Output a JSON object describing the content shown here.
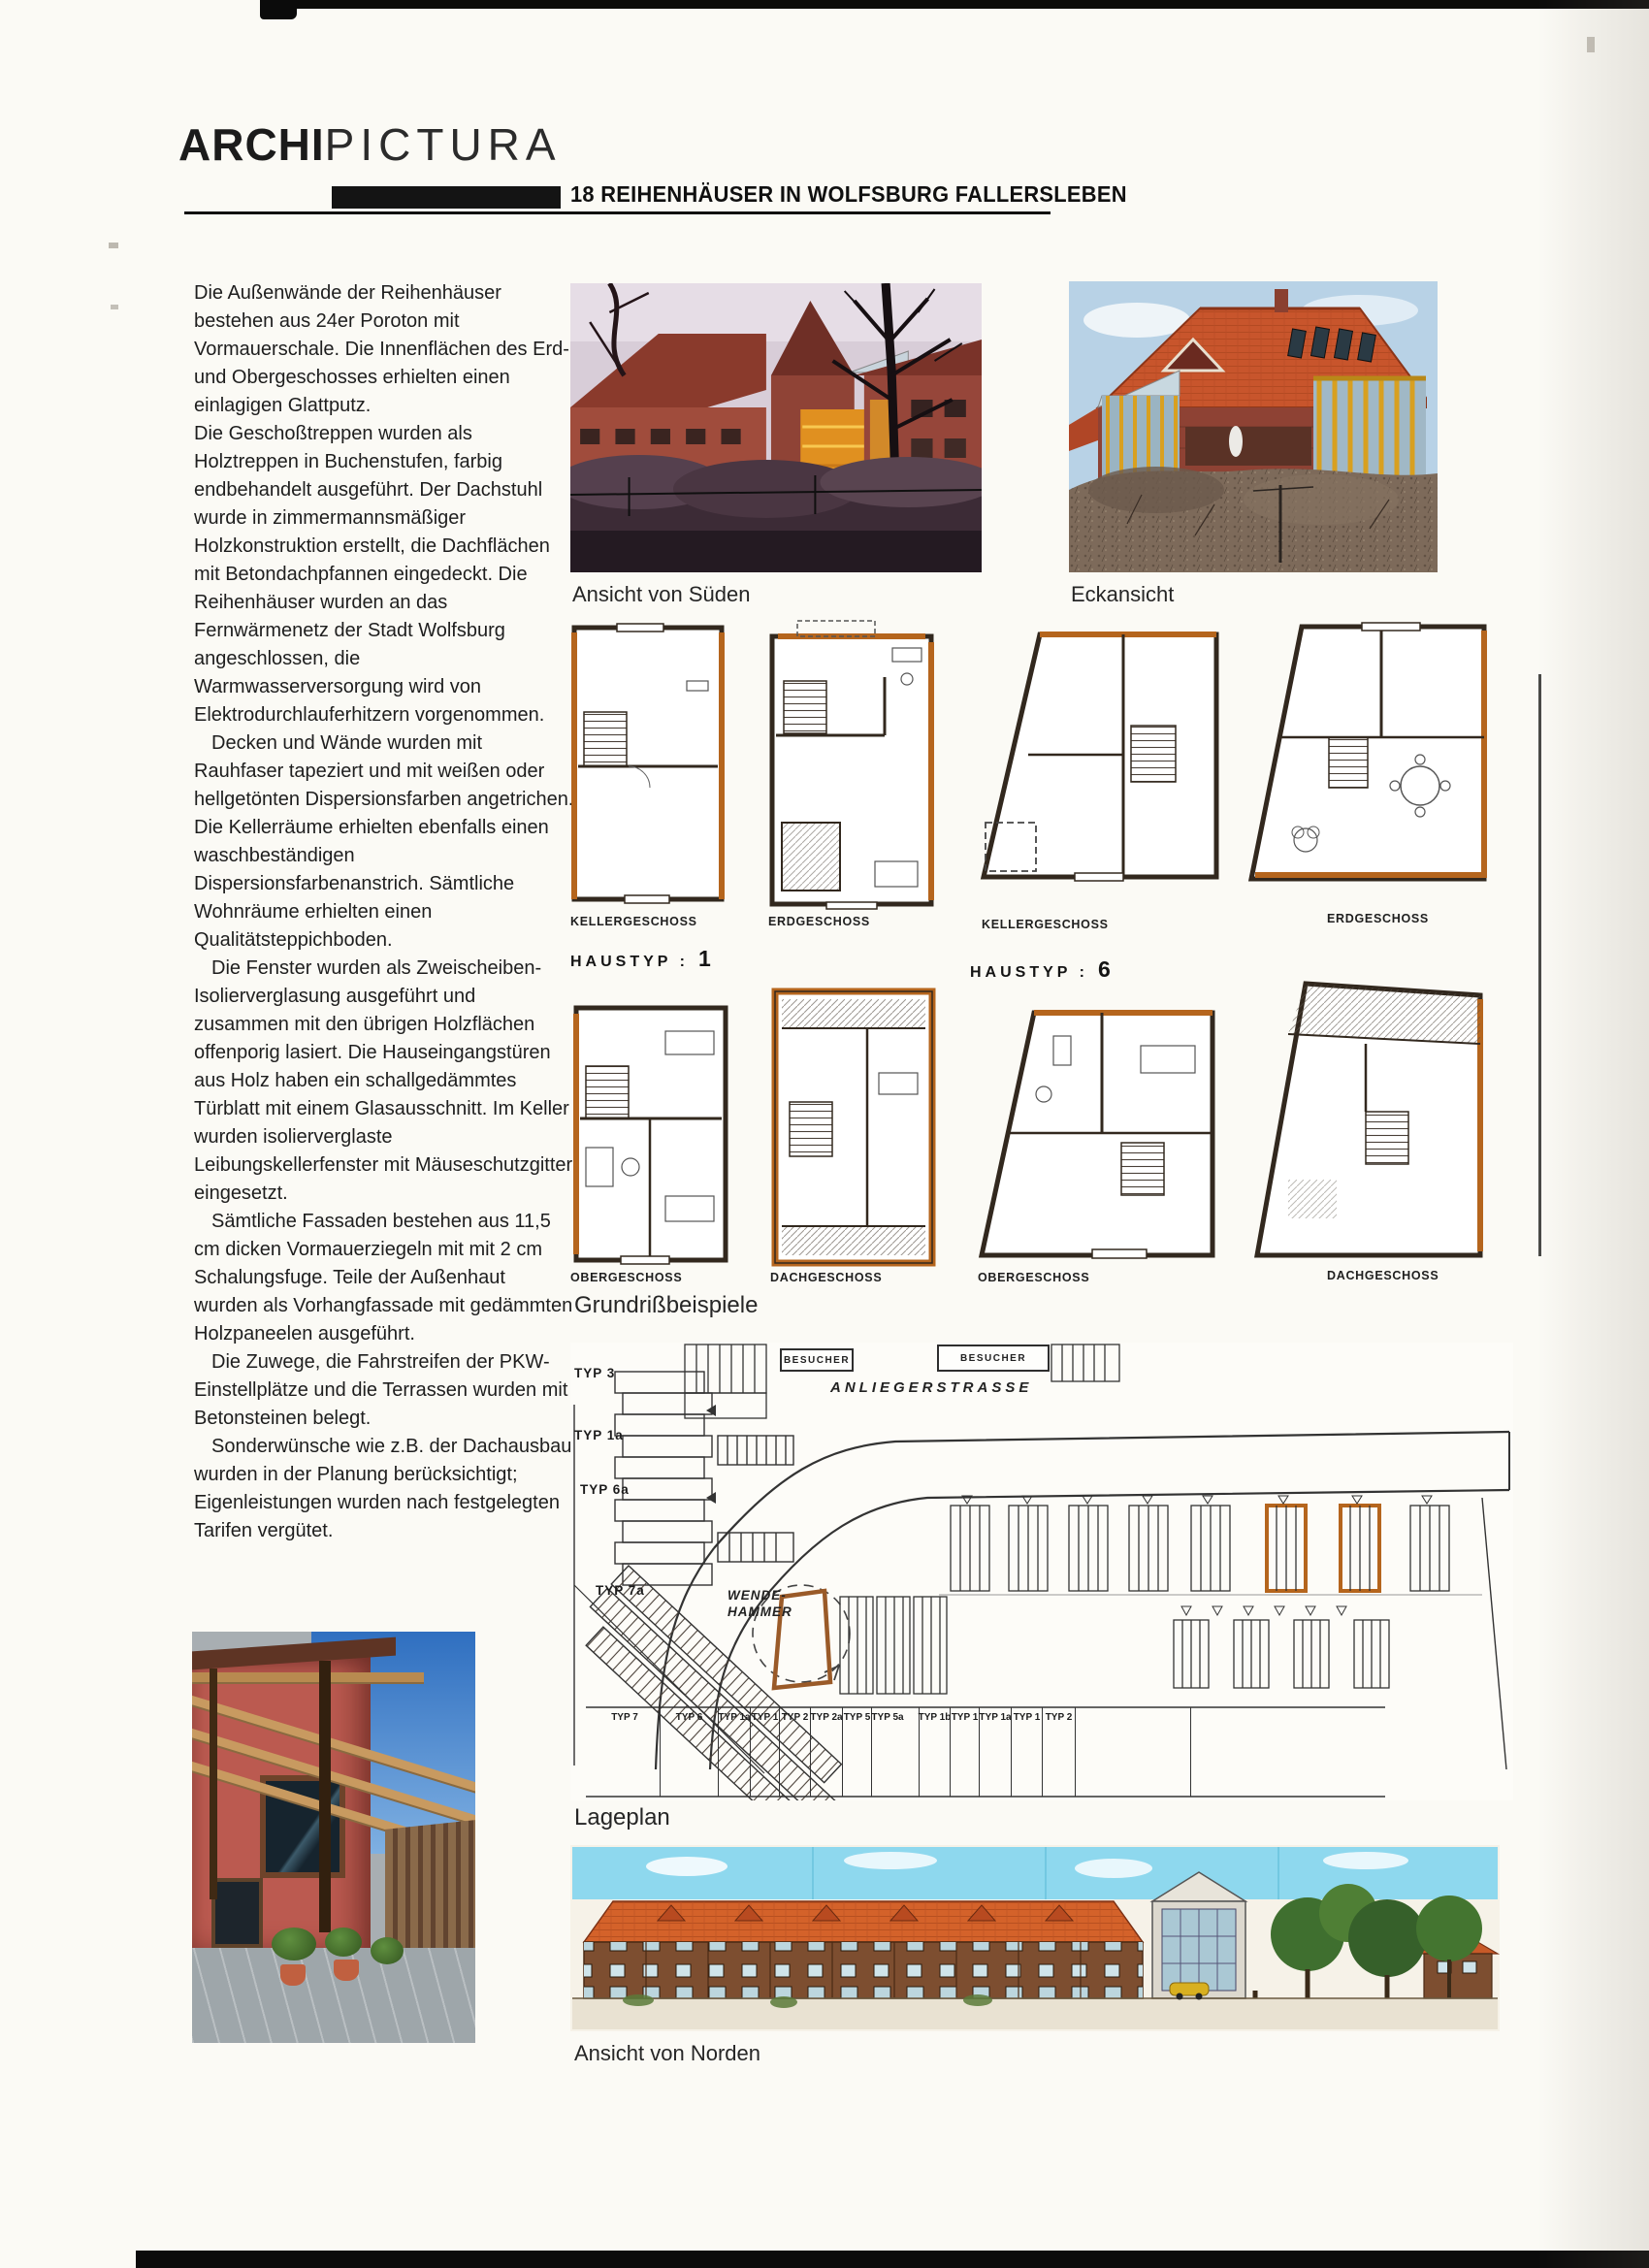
{
  "header": {
    "brand_bold": "ARCHI",
    "brand_light": "PICTURA",
    "title": "18 REIHENHÄUSER IN WOLFSBURG FALLERSLEBEN"
  },
  "article": {
    "p1": "Die Außenwände der Reihenhäuser bestehen aus 24er Poroton mit Vormauerschale. Die Innenflächen des Erd- und Obergeschosses erhielten einen einlagigen Glattputz.",
    "p2": "Die Geschoßtreppen wurden als Holztreppen in Buchenstufen, farbig endbehandelt ausgeführt. Der Dachstuhl wurde in zimmermannsmäßiger Holzkonstruktion erstellt, die Dachflächen mit Betondachpfannen eingedeckt. Die Reihenhäuser wurden an das Fernwärmenetz der Stadt Wolfsburg angeschlossen, die Warmwasserversorgung wird von Elektrodurchlauferhitzern vorgenommen.",
    "p3": "Decken und Wände wurden mit Rauhfaser tapeziert und mit weißen oder hellgetönten Dispersionsfarben angetrichen. Die Kellerräume erhielten ebenfalls einen waschbeständigen Dispersionsfarbenanstrich. Sämtliche Wohnräume erhielten einen Qualitätsteppichboden.",
    "p4": "Die Fenster wurden als Zweischeiben-Isolierverglasung ausgeführt und zusammen mit den übrigen Holzflächen offenporig lasiert. Die Hauseingangstüren aus Holz haben ein schallgedämmtes Türblatt mit einem Glasausschnitt. Im Keller wurden isolierverglaste Leibungskellerfenster mit Mäuseschutzgitter eingesetzt.",
    "p5": "Sämtliche Fassaden bestehen aus 11,5 cm dicken Vormauerziegeln mit mit 2 cm Schalungsfuge. Teile der Außenhaut wurden als Vorhangfassade mit gedämmten Holzpaneelen ausgeführt.",
    "p6": "Die Zuwege, die Fahrstreifen der PKW-Einstellplätze und die Terrassen wurden mit Betonsteinen belegt.",
    "p7": "Sonderwünsche wie z.B. der Dachausbau wurden in der Planung berücksichtigt; Eigenleistungen wurden nach festgelegten Tarifen vergütet."
  },
  "captions": {
    "south": "Ansicht von Süden",
    "corner": "Eckansicht",
    "plans": "Grundrißbeispiele",
    "siteplan": "Lageplan",
    "north": "Ansicht von Norden"
  },
  "plans": {
    "haustyp1_label": "HAUSTYP :",
    "haustyp1_num": "1",
    "haustyp6_label": "HAUSTYP :",
    "haustyp6_num": "6",
    "row1_labels": [
      "KELLERGESCHOSS",
      "ERDGESCHOSS",
      "KELLERGESCHOSS",
      "ERDGESCHOSS"
    ],
    "row2_labels": [
      "OBERGESCHOSS",
      "DACHGESCHOSS",
      "OBERGESCHOSS",
      "DACHGESCHOSS"
    ]
  },
  "siteplan": {
    "street_label": "ANLIEGERSTRASSE",
    "visitor_label_1": "BESUCHER",
    "visitor_label_2": "BESUCHER",
    "turning_label": "WENDE-HAMMER",
    "left_types": [
      "TYP 3",
      "TYP 1a",
      "TYP 6a",
      "TYP 7a"
    ],
    "bottom_types": [
      "TYP 7",
      "TYP 6",
      "TYP 1a",
      "TYP 1",
      "TYP 2",
      "TYP 2a",
      "TYP 5",
      "TYP 5a",
      "TYP 1b",
      "TYP 1",
      "TYP 1a",
      "TYP 1",
      "TYP 2"
    ]
  },
  "colors": {
    "accent_orange": "#b5651d",
    "roof_red": "#c8552c",
    "sky_cyan": "#8ed8ee",
    "ink": "#1c1c1c"
  }
}
